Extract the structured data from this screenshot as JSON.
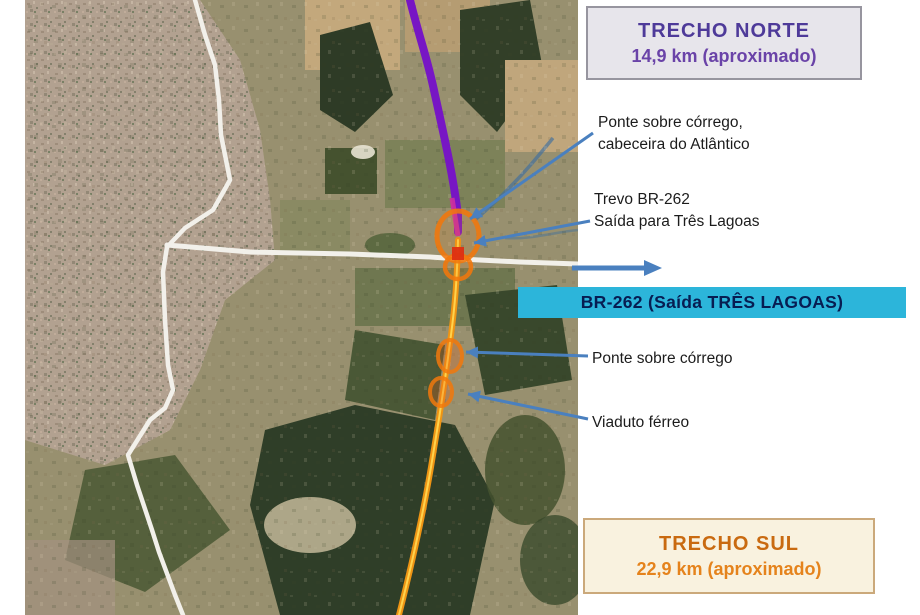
{
  "figure": {
    "description": "Satellite map of road sections (trechos) around BR-262 junction",
    "left_margin_color": "#ffffff"
  },
  "boxes": {
    "trecho_norte": {
      "title": "TRECHO NORTE",
      "subtitle": "14,9 km (aproximado)",
      "text_color": "#4e3a99",
      "bg": "#e7e5eb",
      "border": "#97959f"
    },
    "trecho_sul": {
      "title": "TRECHO SUL",
      "subtitle": "22,9 km (aproximado)",
      "text_color": "#c96a10",
      "bg": "#f9f2df",
      "border": "#cba97b"
    }
  },
  "banner": {
    "label": "BR-262 (Saída TRÊS LAGOAS)",
    "bg": "#2cb5da",
    "text_color": "#071d52"
  },
  "annotations": [
    {
      "lines": [
        "Ponte sobre córrego,",
        "cabeceira do Atlântico"
      ]
    },
    {
      "lines": [
        "Trevo BR-262",
        "Saída para Três Lagoas"
      ]
    },
    {
      "lines": [
        "Ponte sobre córrego"
      ]
    },
    {
      "lines": [
        "Viaduto férreo"
      ]
    }
  ],
  "map": {
    "north_route_color": "#7716c4",
    "south_route_color": "#ee9414",
    "road_color": "#f2f0ea",
    "leader_arrow_color": "#4a80bf",
    "highlight_marker_color": "#f2780c",
    "junction_dot_color": "#dd2f12",
    "stream_color": "#3f6f9e"
  }
}
